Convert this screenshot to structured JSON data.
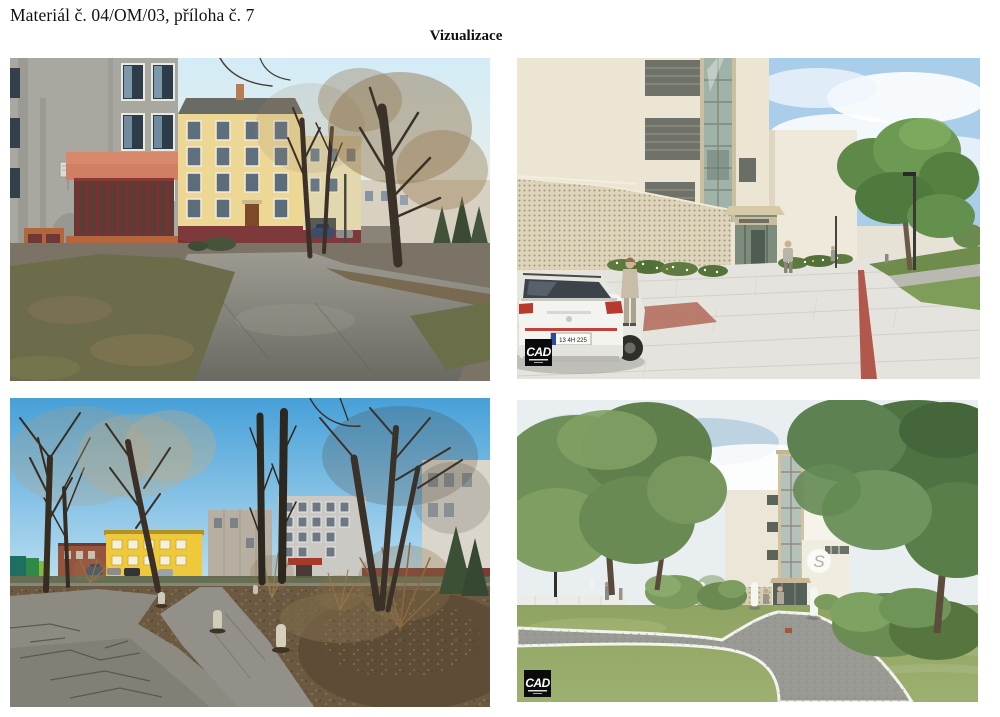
{
  "document": {
    "reference": "Materiál č. 04/OM/03, příloha č. 7",
    "title": "Vizualizace"
  },
  "figures": [
    {
      "id": "photo-existing-courtyard",
      "kind": "photograph",
      "alt": "Existing state photo: courtyard between a grey panel building with salmon balcony and a yellow apartment house, bare winter trees, asphalt path"
    },
    {
      "id": "render-new-entrance",
      "kind": "visualization",
      "alt": "Rendering: new entrance with perforated beige facade and glazed lift shaft, light paved plaza with red line, white car and green tree"
    },
    {
      "id": "photo-existing-park",
      "kind": "photograph",
      "alt": "Existing state photo: park with bare trees, cracked asphalt paths, concrete bollards, yellow and grey buildings behind"
    },
    {
      "id": "render-new-park",
      "kind": "visualization",
      "alt": "Rendering: landscaped park with curving asphalt path, white bollards, street lamp and building with timber-glass staircase tower"
    }
  ],
  "watermark": {
    "text": "CAD"
  },
  "details": {
    "license_plate": "13 4H 225",
    "facade_logo": "S"
  },
  "colors": {
    "page_bg": "#ffffff",
    "text": "#111111",
    "accent_red_line": "#b2574c",
    "watermark_bg": "#0b0b0b",
    "winter_sky": "#47a0d8",
    "render_grass": "#7d9d58"
  }
}
